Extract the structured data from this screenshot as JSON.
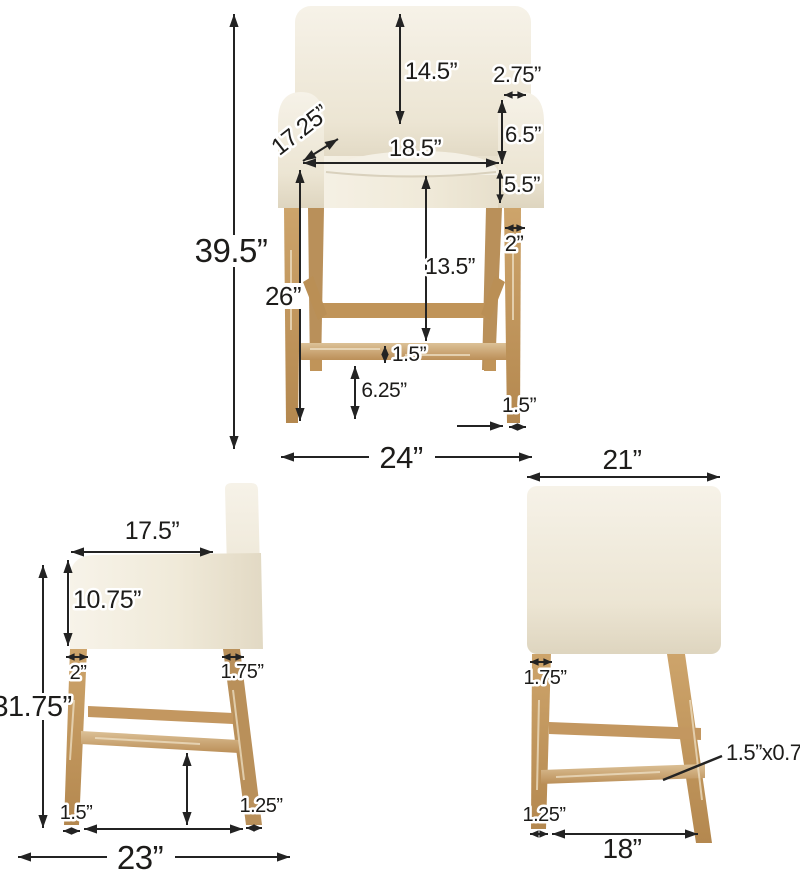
{
  "diagram": {
    "subject": "upholstered counter stool with wooden legs",
    "units": "inches",
    "view_names": [
      "front",
      "side",
      "back"
    ]
  },
  "colors": {
    "background": "#ffffff",
    "fabric": "#f1ecdf",
    "fabric_shadow": "#ded5bf",
    "wood": "#c79e63",
    "wood_dark": "#b08350",
    "dimension_line": "#232323",
    "label_text": "#1d1c1a",
    "label_halo": "#ffffff"
  },
  "views": {
    "front": {
      "backrest_height": "14.5”",
      "arm_top_width": "2.75”",
      "seat_diagonal_depth": "17.25”",
      "arm_to_seat": "6.5”",
      "seat_width": "18.5”",
      "seat_thickness": "5.5”",
      "leg_top_width": "2”",
      "seat_to_footrest": "13.5”",
      "overall_height": "39.5”",
      "seat_height": "26”",
      "footrest_thickness": "1.5”",
      "footrest_to_floor": "6.25”",
      "foot_width": "1.5”",
      "overall_width": "24”"
    },
    "side": {
      "arm_depth": "17.5”",
      "front_height": "10.75”",
      "front_leg_width": "2”",
      "back_leg_width": "1.75”",
      "arm_height": "31.75”",
      "front_foot_width": "1.5”",
      "back_foot_width": "1.25”",
      "overall_depth": "23”"
    },
    "back": {
      "back_width": "21”",
      "leg_top_width": "1.75”",
      "stretcher_section": "1.5”x0.75”",
      "foot_width": "1.25”",
      "floor_leg_span": "18”"
    }
  }
}
